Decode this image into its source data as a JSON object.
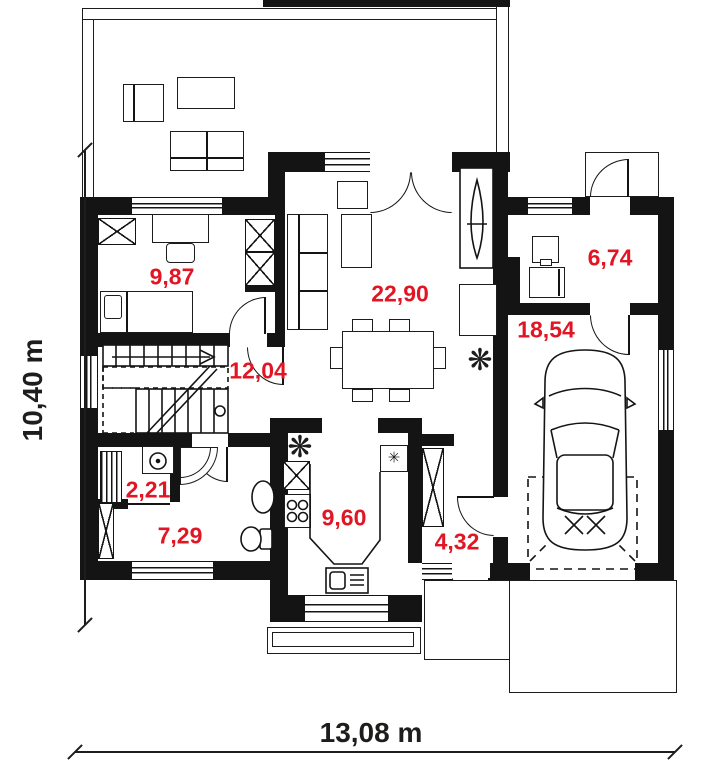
{
  "plan": {
    "rooms": [
      {
        "name": "bedroom",
        "area": "9,87"
      },
      {
        "name": "living-dining-room",
        "area": "22,90"
      },
      {
        "name": "hall-staircase",
        "area": "12,04"
      },
      {
        "name": "laundry-wc",
        "area": "2,21"
      },
      {
        "name": "bathroom",
        "area": "7,29"
      },
      {
        "name": "kitchen",
        "area": "9,60"
      },
      {
        "name": "vestibule",
        "area": "4,32"
      },
      {
        "name": "utility-room",
        "area": "6,74"
      },
      {
        "name": "garage",
        "area": "18,54"
      }
    ],
    "dimensions": {
      "overall_width": "13,08 m",
      "overall_depth": "10,40 m"
    },
    "symbols": {
      "freezer": "✳",
      "plant": "❋"
    },
    "colors": {
      "wall": "#141414",
      "room_label": "#e11523",
      "dimension_text": "#1d1d1b",
      "background": "#ffffff"
    }
  }
}
